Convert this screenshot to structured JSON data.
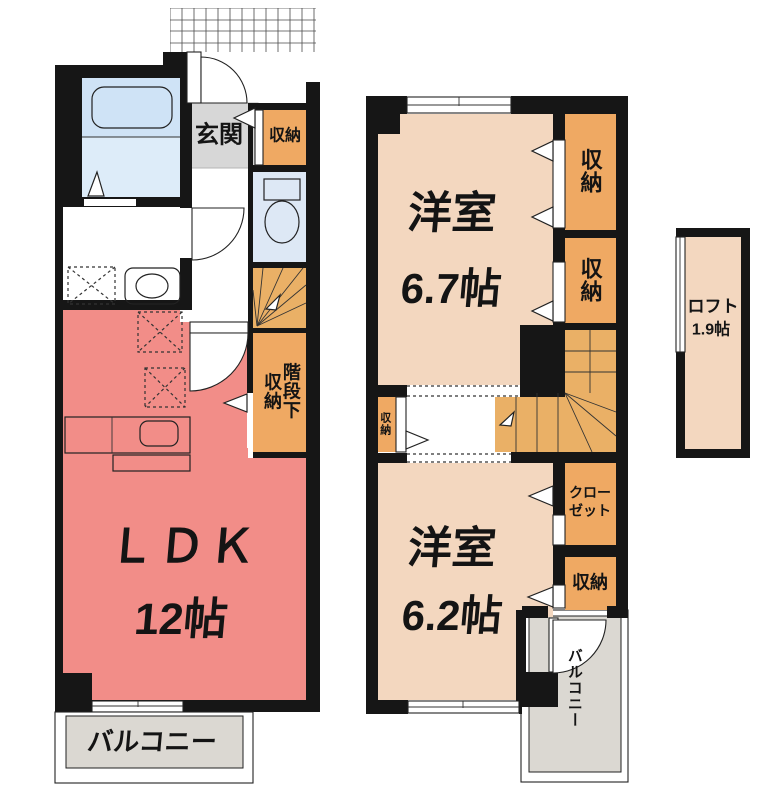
{
  "floor1": {
    "entrance_label": "玄関",
    "entrance_storage_label": "収納",
    "understair_line1": "階段下",
    "understair_line2": "収納",
    "ldk_name": "ＬＤＫ",
    "ldk_size": "12帖",
    "balcony_label": "バルコニー"
  },
  "floor2": {
    "room_a_name": "洋室",
    "room_a_size": "6.7帖",
    "room_b_name": "洋室",
    "room_b_size": "6.2帖",
    "storage_top_label": "収納",
    "storage_mid_label": "収納",
    "hall_storage_label": "収納",
    "closet_line1": "クロー",
    "closet_line2": "ゼット",
    "storage_bottom_label": "収納",
    "balcony_label": "バルコニー"
  },
  "loft": {
    "name": "ロフト",
    "size": "1.9帖"
  },
  "colors": {
    "wall": "#161616",
    "ldk_pink": "#f28d88",
    "room_beige": "#f3d7bf",
    "storage_orange": "#efa963",
    "stairs_orange": "#eab066",
    "kitchen_tan": "#e2b269",
    "bathroom_blue": "#cfe3f6",
    "bathroom_blue_light": "#ddecf9",
    "fixture_cyan": "#bee9f6",
    "counter_blue": "#c4dcf0",
    "toilet_blue": "#dde8f5",
    "toilet_tank": "#c9daf0",
    "entrance_gray": "#d7d7d7",
    "balcony_gray": "#dbd8d2"
  }
}
